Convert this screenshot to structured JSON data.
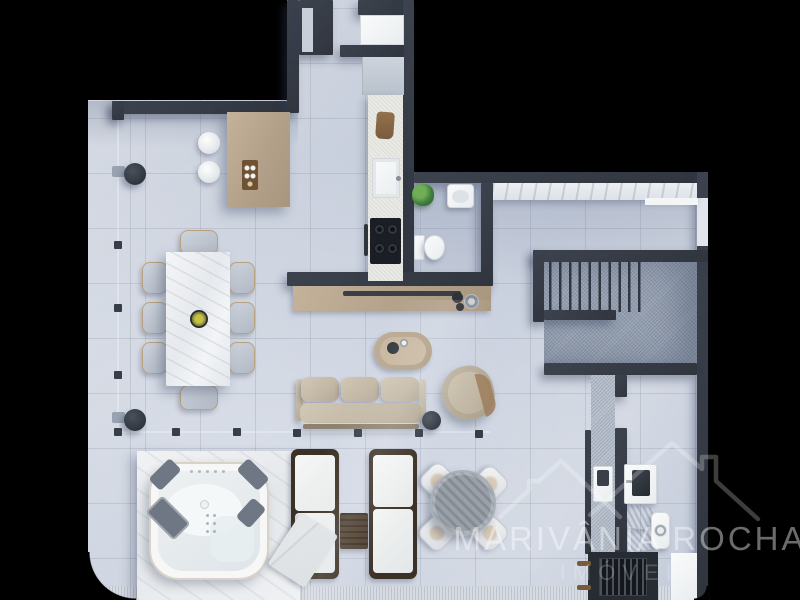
{
  "watermark": {
    "brand": "MARIVÂNIA ROCHA",
    "tagline": "IMÓVEIS",
    "logo": "rooftops-outline-icon"
  },
  "palette": {
    "background": "#000000",
    "wall": "#363b45",
    "floor": "#cbd2de",
    "tile_line": "#8b95a8",
    "stair_carpet": "#97a2b3",
    "wood_light": "#b9a78f",
    "wood_dark": "#453828",
    "marble": "#eff1f3",
    "upholstery_beige": "#c7bdab",
    "fixture_white": "#f4f6f6"
  },
  "scene": {
    "type": "apartment-floor-plan-render",
    "view": "top-down"
  }
}
